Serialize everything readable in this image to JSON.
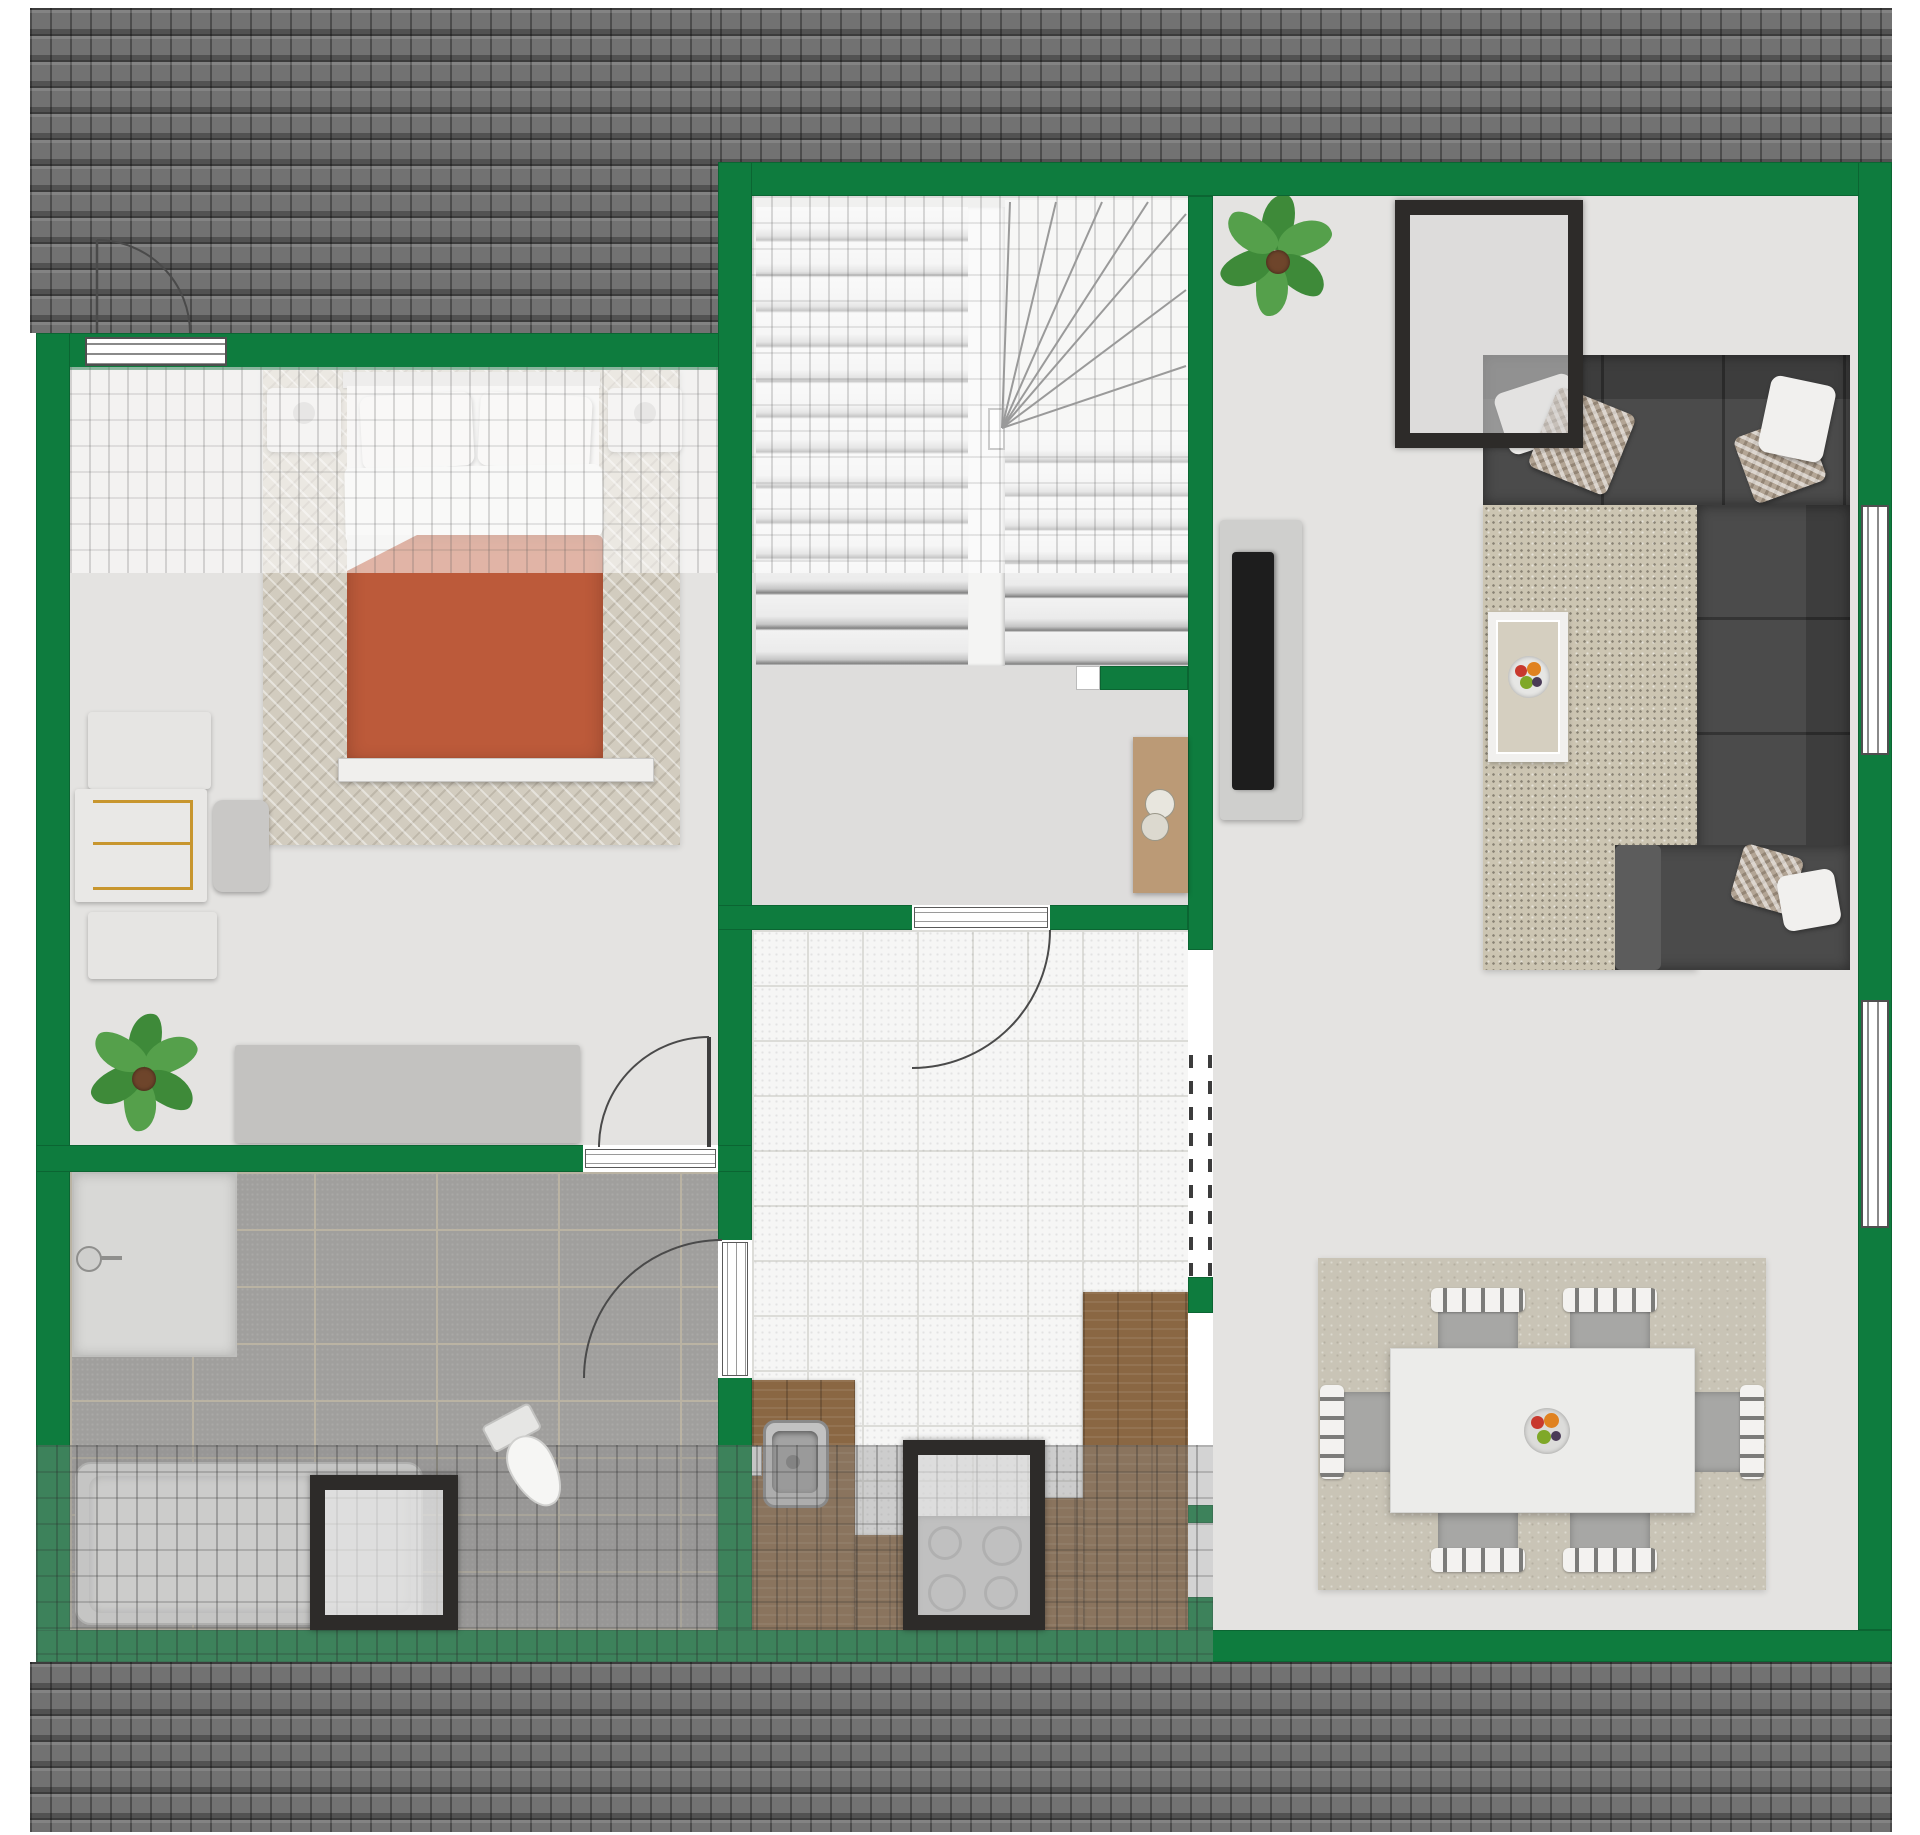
{
  "plan": {
    "view": "top-down attic floor plan, no text labels rendered",
    "palette": {
      "wall_green": "#0e7c3e",
      "roof_gray": "#727272",
      "floor_light_gray": "#e4e3e1",
      "hall_tile_white": "#f6f6f5",
      "bath_tile_gray": "#a09f9d",
      "wood_counter": "#8a6743",
      "sofa_gray": "#4b4b4b",
      "bed_duvet_red": "#bc5a3a",
      "rug_beige": "#ccc5b2",
      "skylight_frame": "#2d2b29",
      "plant_green": "#3e8a39"
    },
    "rooms": [
      {
        "name": "bedroom",
        "furniture": [
          "double-bed",
          "two-pillows",
          "herringbone-rug",
          "nightstand-left",
          "nightstand-right",
          "wardrobe-desk-unit",
          "desk-chair",
          "potted-plant",
          "sideboard",
          "top-wall-window",
          "entry-door"
        ]
      },
      {
        "name": "bathroom",
        "furniture": [
          "shower",
          "wash-basin",
          "toilet",
          "bathtub",
          "roof-window",
          "entry-door"
        ]
      },
      {
        "name": "stair-landing",
        "furniture": [
          "winder-staircase",
          "console-table",
          "door-to-hallway"
        ]
      },
      {
        "name": "hallway-kitchen",
        "furniture": [
          "kitchen-counter-left",
          "kitchen-sink",
          "cooktop",
          "roof-window",
          "kitchen-counter-right"
        ]
      },
      {
        "name": "living-room",
        "furniture": [
          "corner-sofa",
          "sofa-pillows",
          "speckled-rug",
          "coffee-table",
          "fruit-bowl",
          "tv-panel",
          "flat-tv",
          "potted-plant",
          "roof-window",
          "right-wall-window"
        ]
      },
      {
        "name": "dining-area",
        "furniture": [
          "dining-table",
          "fruit-bowl",
          "six-chairs",
          "area-rug",
          "right-wall-window"
        ]
      }
    ],
    "counts": {
      "windows_in_walls": 3,
      "roof_windows": 3,
      "interior_doors": 3,
      "window_swing_arcs": 1,
      "dining_chairs": 6,
      "cooktop_burners": 4,
      "plants": 2,
      "stair_treads_straight_flight": 13,
      "stair_treads_return_flight": 7,
      "sofa_sections": 3
    }
  }
}
